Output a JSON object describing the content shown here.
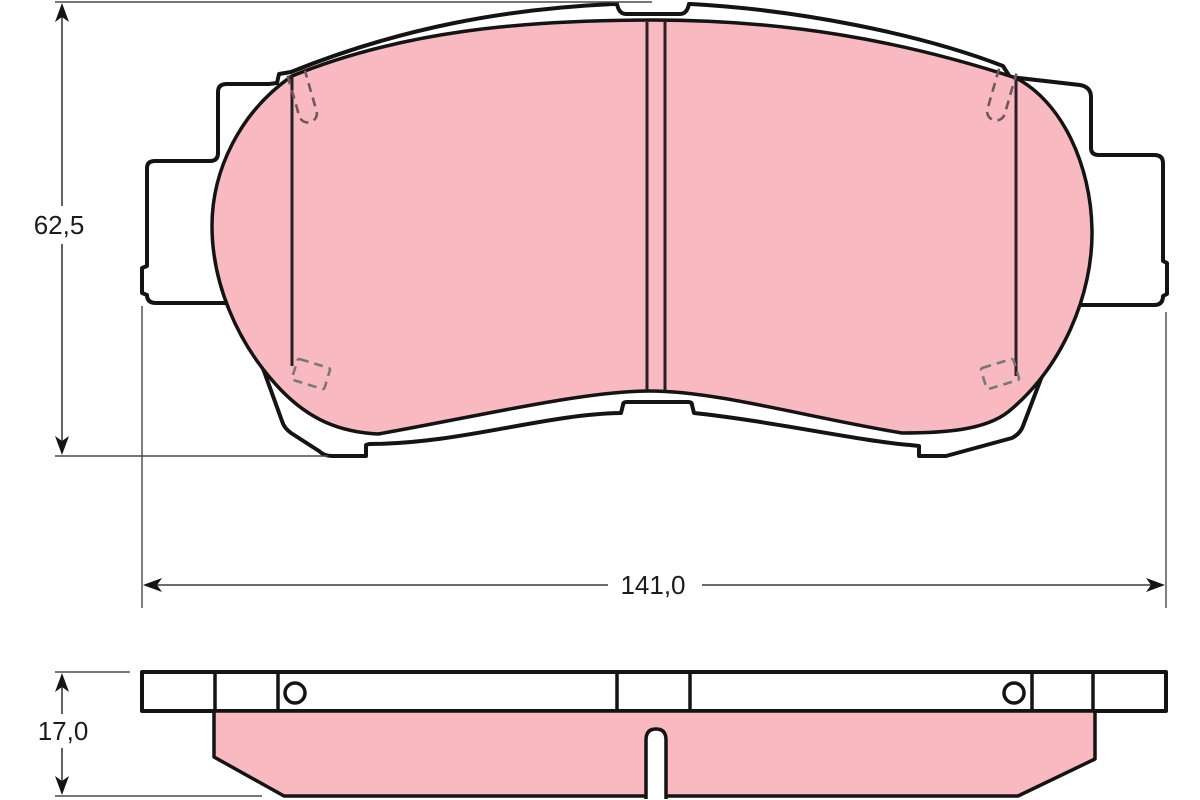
{
  "document": {
    "kind": "technical-dimensional-drawing",
    "subject": "disc brake pad, front view and edge view",
    "background_color": "#ffffff"
  },
  "front_view": {
    "name": "brake pad front view",
    "height_dimension": {
      "label": "62,5"
    },
    "width_dimension": {
      "label": "141,0"
    }
  },
  "edge_view": {
    "name": "brake pad edge view",
    "thickness_dimension": {
      "label": "17,0"
    }
  },
  "colors": {
    "friction_material": "#f8b9c1",
    "outline": "#141414",
    "dimension_lines": "#3c3c3c",
    "hidden_detail_lines": "#787878"
  }
}
